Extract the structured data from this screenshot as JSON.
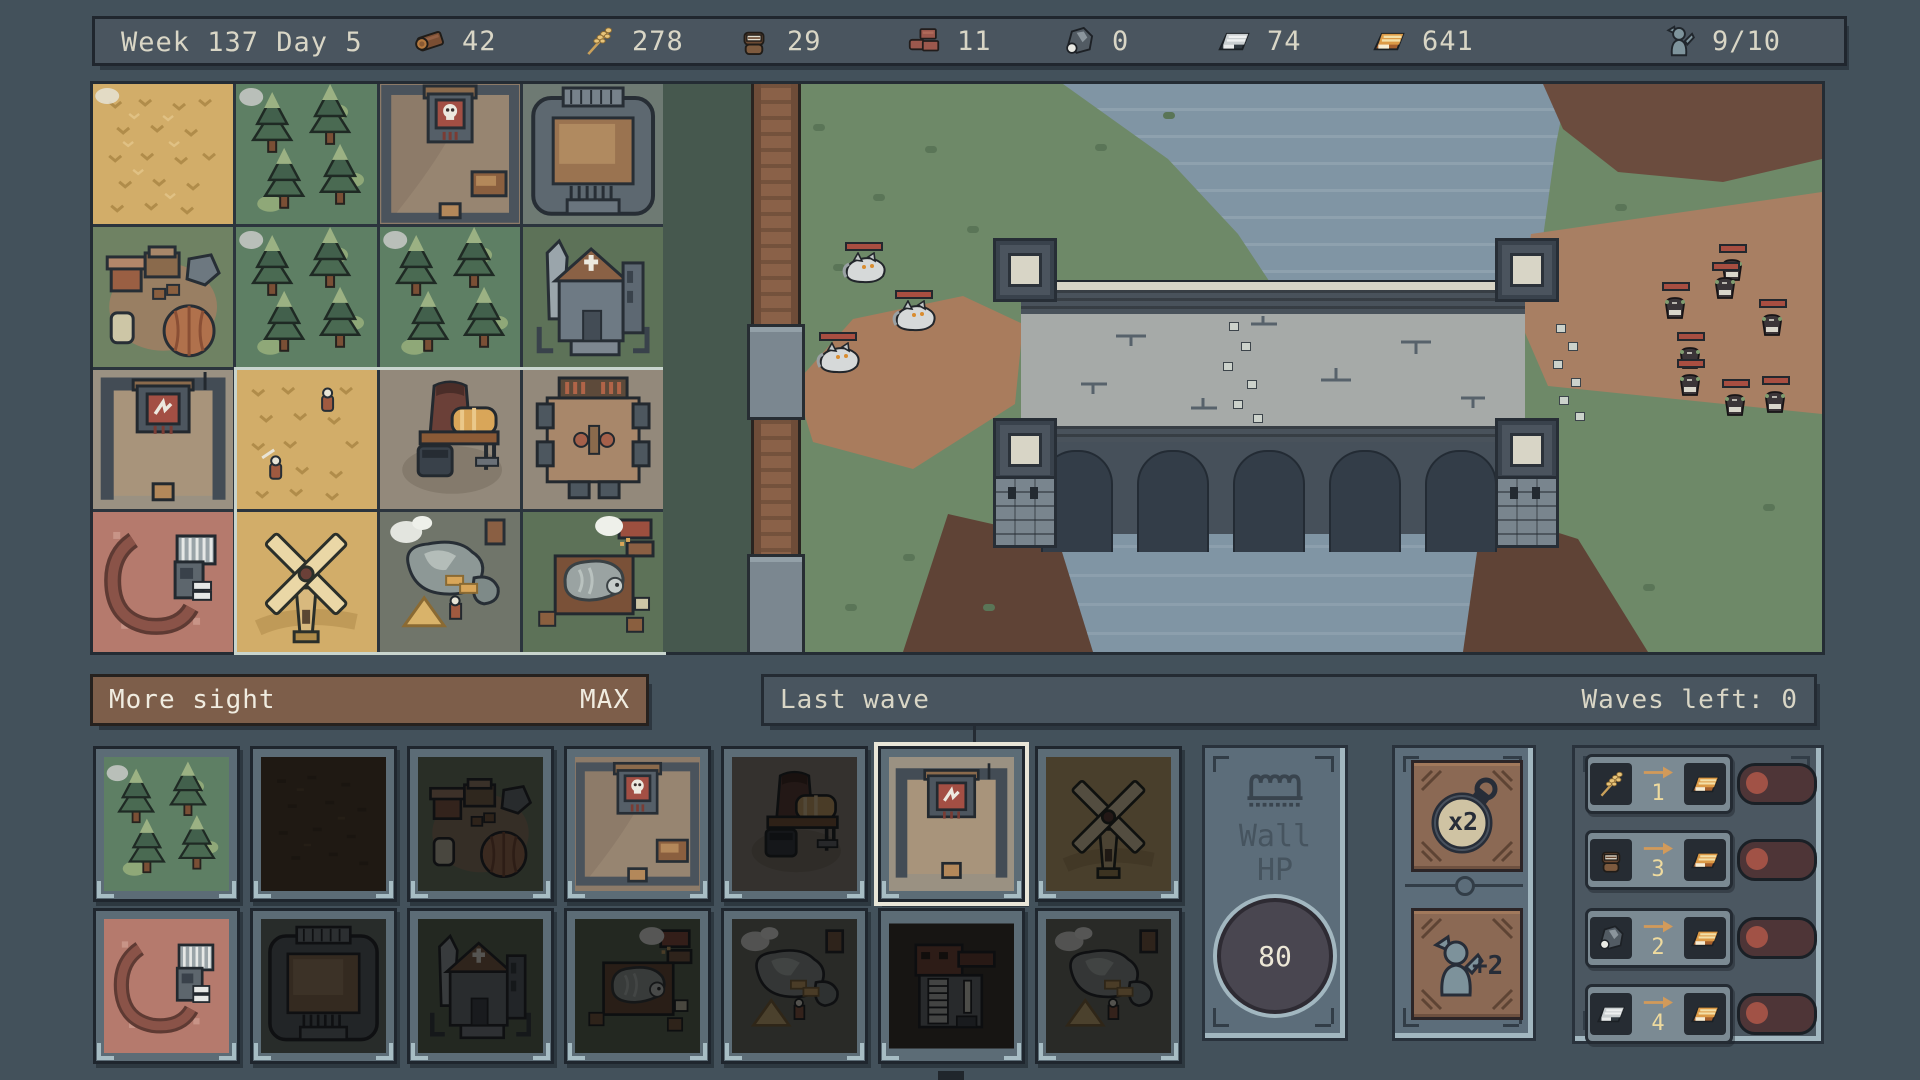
{
  "top_bar": {
    "date": "Week 137 Day 5",
    "resources": [
      {
        "icon": "wood-log",
        "value": "42"
      },
      {
        "icon": "wheat",
        "value": "278"
      },
      {
        "icon": "flour-sack",
        "value": "29"
      },
      {
        "icon": "bricks",
        "value": "11"
      },
      {
        "icon": "ore",
        "value": "0"
      },
      {
        "icon": "silver-ingot",
        "value": "74"
      },
      {
        "icon": "gold-ingot",
        "value": "641"
      }
    ],
    "population": {
      "icon": "villager",
      "value": "9/10"
    }
  },
  "upgrade_bar": {
    "label": "More sight",
    "status": "MAX"
  },
  "wave_bar": {
    "label": "Last wave",
    "right": "Waves left: 0"
  },
  "map": {
    "tiles": [
      {
        "art": "wheat-field"
      },
      {
        "art": "forest"
      },
      {
        "art": "skull-gate"
      },
      {
        "art": "fortress"
      },
      {
        "art": "camp"
      },
      {
        "art": "forest"
      },
      {
        "art": "forest"
      },
      {
        "art": "church"
      },
      {
        "art": "banner-tower"
      },
      {
        "art": "wheat-villagers"
      },
      {
        "art": "forge"
      },
      {
        "art": "tavern"
      },
      {
        "art": "red-quarry"
      },
      {
        "art": "windmill"
      },
      {
        "art": "stone-quarry"
      },
      {
        "art": "butcher"
      }
    ]
  },
  "build_cards": {
    "row1": [
      {
        "art": "forest",
        "lit": true,
        "selected": false
      },
      {
        "art": "dirt",
        "lit": false,
        "selected": false
      },
      {
        "art": "camp",
        "lit": false,
        "selected": false
      },
      {
        "art": "skull-gate",
        "lit": true,
        "selected": false
      },
      {
        "art": "forge",
        "lit": false,
        "selected": false
      },
      {
        "art": "banner-tower",
        "lit": true,
        "selected": true
      },
      {
        "art": "windmill",
        "lit": false,
        "selected": false
      }
    ],
    "row2": [
      {
        "art": "red-quarry",
        "lit": true,
        "selected": false
      },
      {
        "art": "fortress",
        "lit": false,
        "selected": false
      },
      {
        "art": "church",
        "lit": false,
        "selected": false
      },
      {
        "art": "butcher",
        "lit": false,
        "selected": false
      },
      {
        "art": "stone-quarry",
        "lit": false,
        "selected": false
      },
      {
        "art": "house",
        "lit": false,
        "selected": false
      },
      {
        "art": "stone-quarry",
        "lit": false,
        "selected": false
      }
    ]
  },
  "wall_panel": {
    "icon": "crown",
    "line1": "Wall",
    "line2": "HP",
    "value": "80"
  },
  "speed_panel": {
    "multiplier": "x2",
    "population_bonus": "+2"
  },
  "trade_panel": {
    "rows": [
      {
        "from": "wheat",
        "amount": "1",
        "to": "gold-ingot",
        "enabled": false
      },
      {
        "from": "flour-sack",
        "amount": "3",
        "to": "gold-ingot",
        "enabled": false
      },
      {
        "from": "ore",
        "amount": "2",
        "to": "gold-ingot",
        "enabled": false
      },
      {
        "from": "silver-ingot",
        "amount": "4",
        "to": "gold-ingot",
        "enabled": false
      }
    ]
  },
  "battlefield": {
    "wolves": {
      "count": 3,
      "positions": [
        [
          178,
          168
        ],
        [
          228,
          216
        ],
        [
          152,
          258
        ]
      ]
    },
    "raiders": {
      "count": 8,
      "positions": [
        [
          1056,
          170
        ],
        [
          1049,
          188
        ],
        [
          999,
          208
        ],
        [
          1096,
          225
        ],
        [
          1014,
          258
        ],
        [
          1014,
          285
        ],
        [
          1059,
          305
        ],
        [
          1099,
          302
        ]
      ]
    }
  },
  "colors": {
    "background": "#43515b",
    "accent_brown": "#7d5e4a",
    "banner_red": "#a34f44",
    "toggle_red": "#a15246",
    "gold_text": "#eeda9e",
    "water": "#8095a4"
  }
}
